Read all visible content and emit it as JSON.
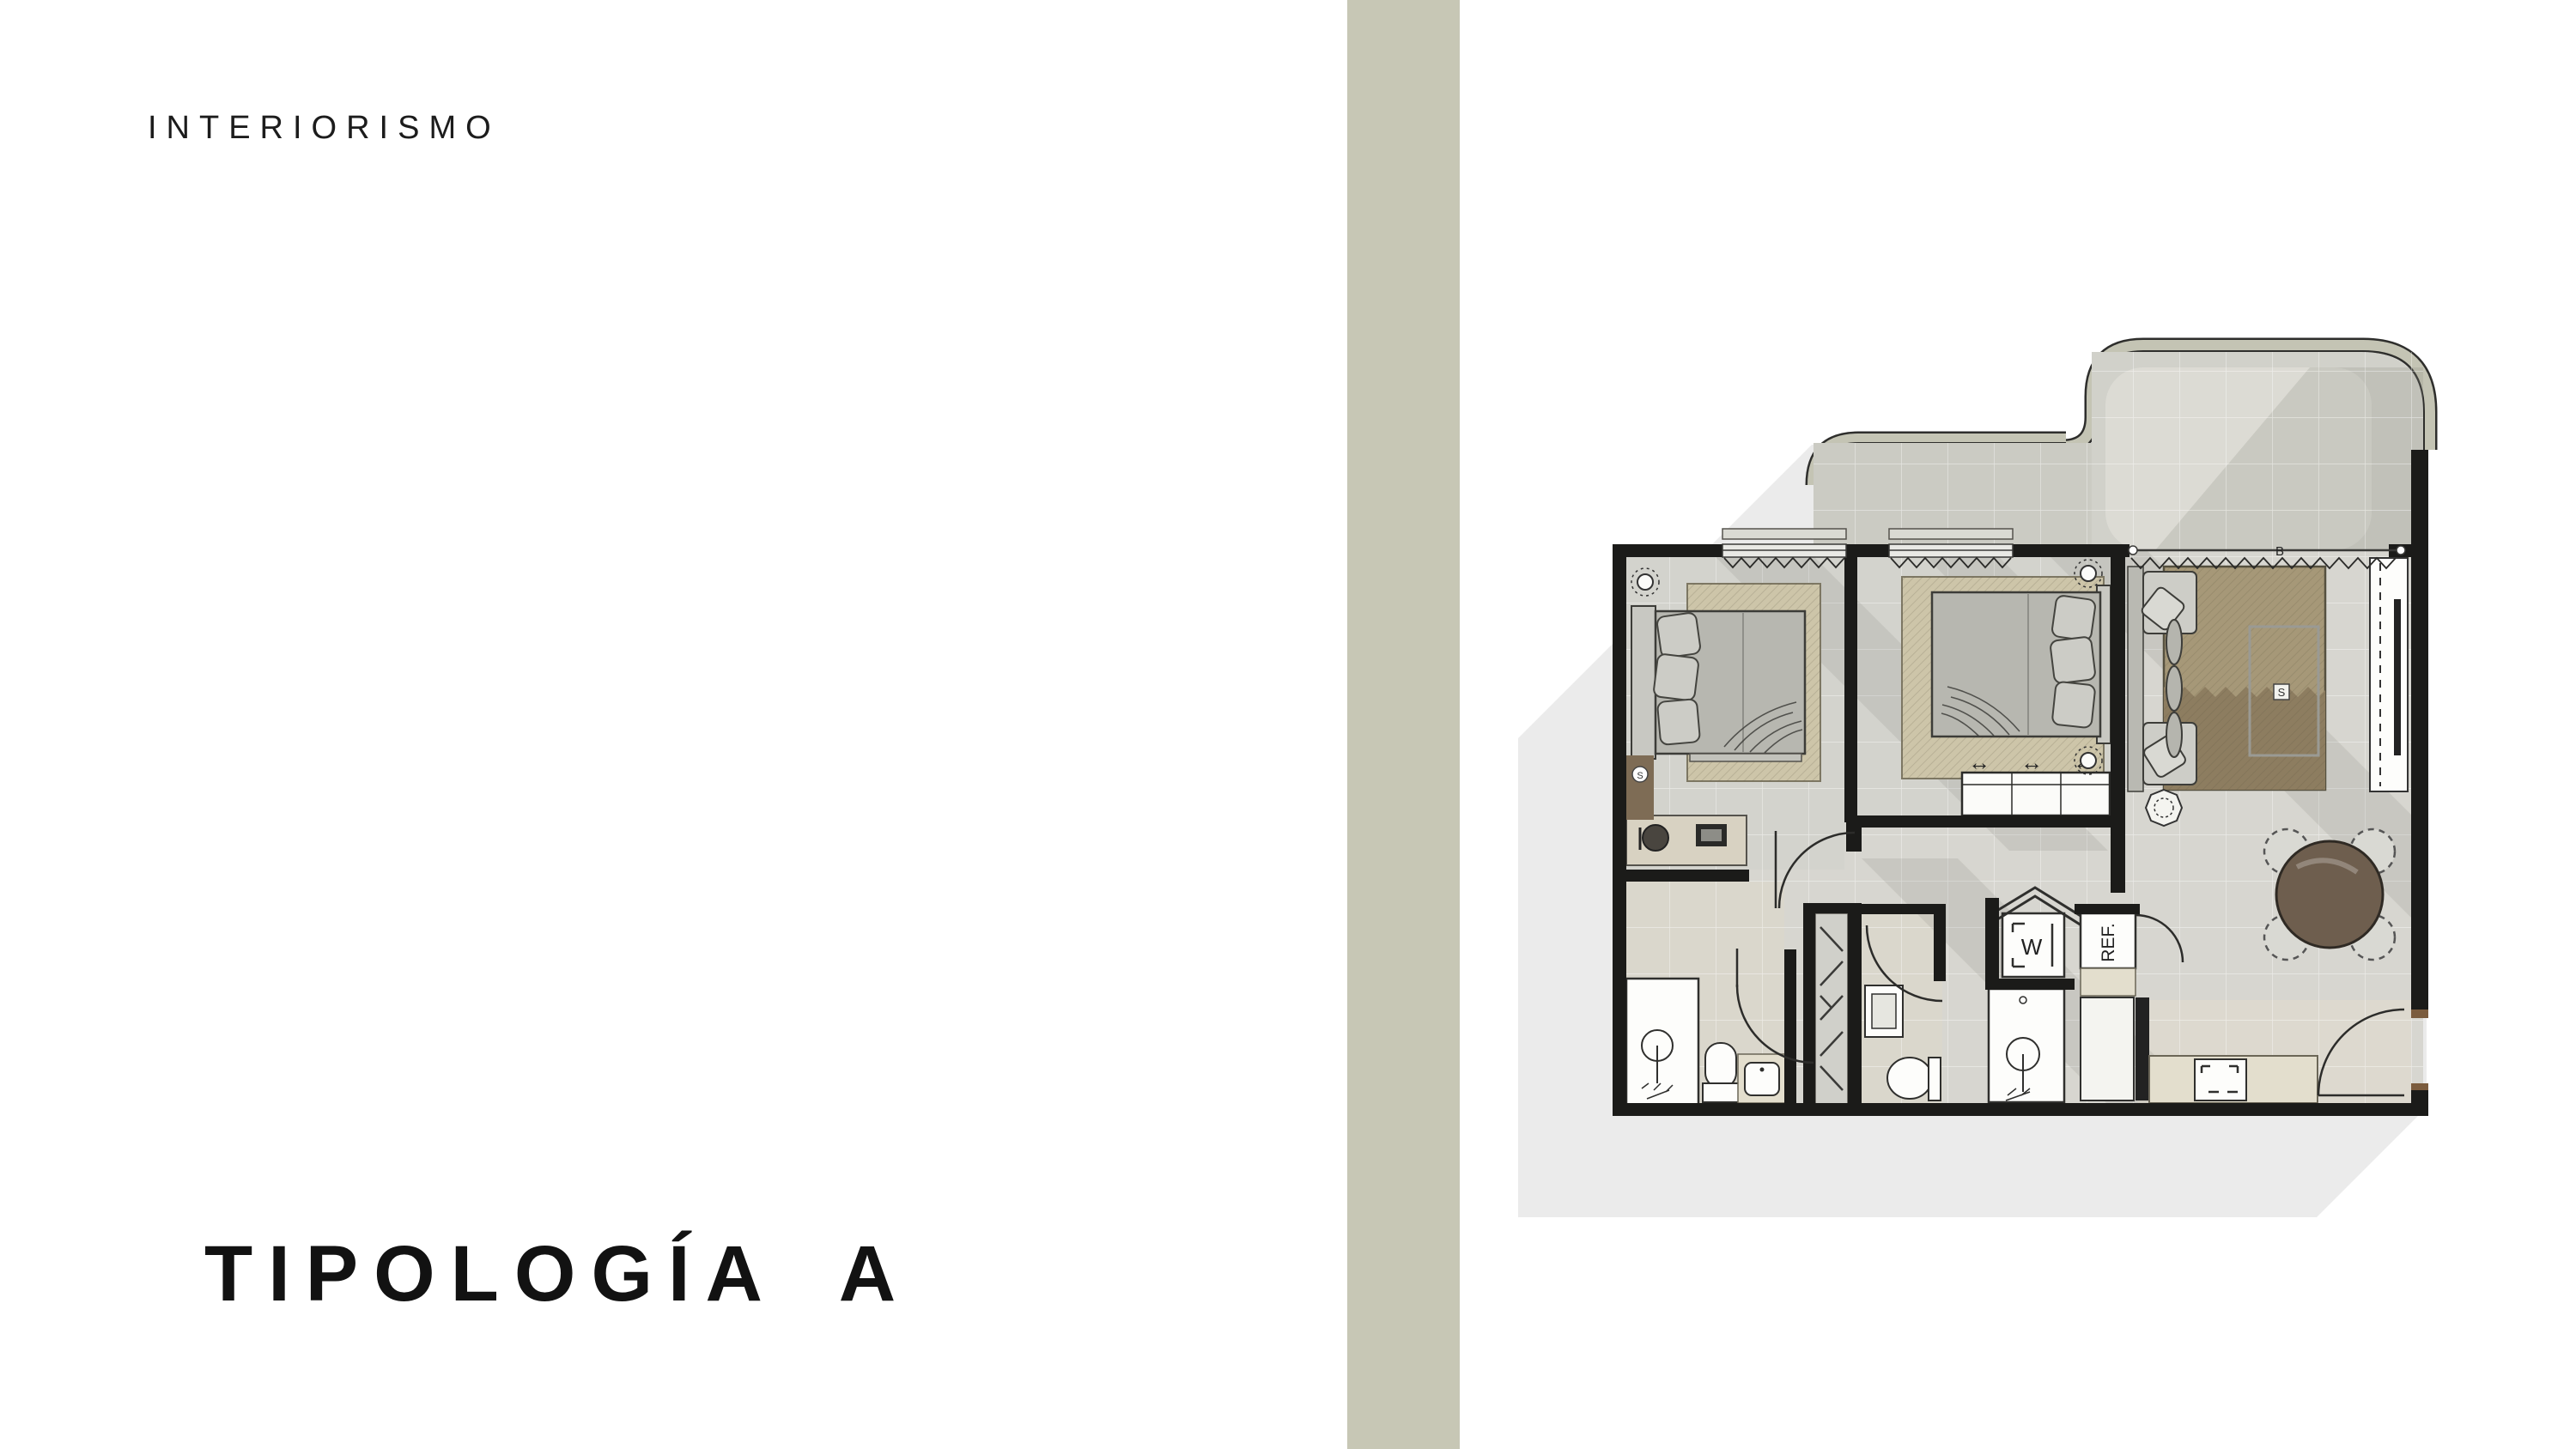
{
  "slide": {
    "eyebrow": "INTERIORISMO",
    "title": "TIPOLOGÍA A",
    "background": "#ffffff",
    "stripe_color": "#c7c7b5"
  },
  "floorplan": {
    "type": "apartment-floor-plan",
    "labels": {
      "washer": "W",
      "fridge": "REF.",
      "rug_marker": "S",
      "bedroom_marker": "S",
      "section_marker": "B",
      "wardrobe_arrows": "↔"
    },
    "colors": {
      "wall": "#1b1b19",
      "shadow": "#ebebeb",
      "floor": "#d7d6d0",
      "bedroom_floor": "#d3d3cd",
      "bath_floor": "#dad7cc",
      "terrace_band": "#c4c4b4",
      "terrace_floor": "#d1d1ca",
      "terrace_inner": "#dcdbd4",
      "balcony_floor": "#cbcbc3",
      "rug_living_light": "#a69878",
      "rug_living_dark": "#8d7d60",
      "rug_bedroom": "#cdc5a9",
      "bedding": "#b7b7b0",
      "table_wood": "#6e5e4e",
      "counter": "#e3decd",
      "wood_accent": "#7e6c55",
      "fixture_white": "#fdfdfb"
    }
  }
}
